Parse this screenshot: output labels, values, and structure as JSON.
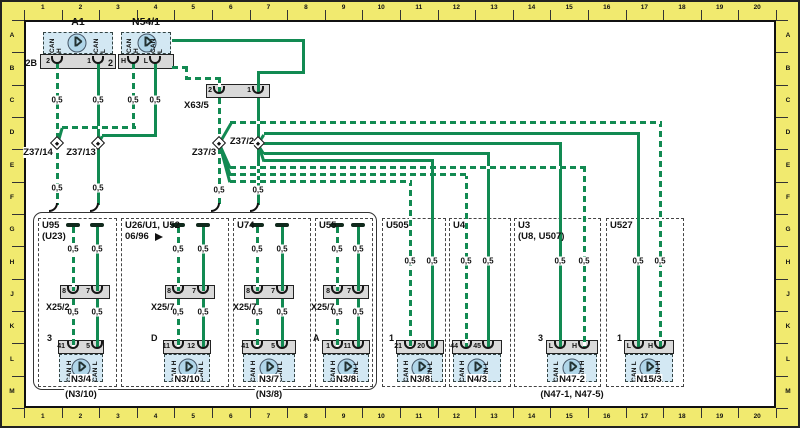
{
  "frame": {
    "columns": [
      "1",
      "2",
      "3",
      "4",
      "5",
      "6",
      "7",
      "8",
      "9",
      "10",
      "11",
      "12",
      "13",
      "14",
      "15",
      "16",
      "17",
      "18",
      "19",
      "20"
    ],
    "rows": [
      "A",
      "B",
      "C",
      "D",
      "E",
      "F",
      "G",
      "H",
      "J",
      "K",
      "L",
      "M"
    ]
  },
  "wire": {
    "gauge": "0,5",
    "green": "#128a52",
    "stripe_gap": "#ffffff"
  },
  "top": {
    "a1": {
      "name": "A1",
      "plug": "2B",
      "pins": [
        "2",
        "1"
      ],
      "can": [
        "CAN H",
        "CAN L"
      ]
    },
    "n54": {
      "name": "N54/1",
      "plug": "2",
      "pins": [
        "H",
        "L"
      ],
      "can": [
        "CAN H",
        "CAN L"
      ]
    },
    "x63": {
      "name": "X63/5",
      "pins": [
        "2",
        "1"
      ]
    },
    "splices": [
      "Z37/14",
      "Z37/13",
      "Z37/3",
      "Z37/2"
    ]
  },
  "sections": [
    {
      "titles": [
        "U95",
        "(U23)"
      ],
      "connector": {
        "name": "X25/2",
        "pins": [
          "8",
          "7"
        ]
      },
      "device": {
        "name": "N3/4",
        "subname": "(N3/10)",
        "plug": "3",
        "pins": [
          "41",
          "5"
        ],
        "can": [
          "CAN H",
          "CAN L"
        ]
      }
    },
    {
      "titles": [
        "U26/U1, U52",
        "06/96"
      ],
      "connector": {
        "name": "X25/7",
        "pins": [
          "8",
          "7"
        ]
      },
      "device": {
        "name": "N3/10",
        "plug": "D",
        "pins": [
          "11",
          "12"
        ],
        "can": [
          "CAN H",
          "CAN L"
        ]
      }
    },
    {
      "titles": [
        "U74"
      ],
      "connector": {
        "name": "X25/7",
        "pins": [
          "8",
          "7"
        ]
      },
      "device": {
        "name": "N3/7",
        "subname": "(N3/8)",
        "pins": [
          "41",
          "5"
        ],
        "can": [
          "CAN H",
          "CAN L"
        ]
      }
    },
    {
      "titles": [
        "U55"
      ],
      "connector": {
        "name": "X25/7",
        "pins": [
          "8",
          "7"
        ]
      },
      "device": {
        "name": "N3/8",
        "plug": "A",
        "pins": [
          "1",
          "11"
        ],
        "can": [
          "CAN H",
          "CAN L"
        ]
      }
    },
    {
      "titles": [
        "U505"
      ],
      "device": {
        "name": "N3/8",
        "plug": "1",
        "pins": [
          "21",
          "20"
        ],
        "can": [
          "CAN H",
          "CAN L"
        ]
      }
    },
    {
      "titles": [
        "U4"
      ],
      "device": {
        "name": "N4/3",
        "pins": [
          "44",
          "45"
        ],
        "can": [
          "CAN H",
          "CAN L"
        ]
      }
    },
    {
      "titles": [
        "U3",
        "(U8, U507)"
      ],
      "device": {
        "name": "N47-2",
        "subname": "(N47-1, N47-5)",
        "plug": "3",
        "pins": [
          "L",
          "H"
        ],
        "can": [
          "CAN L",
          "CAN H"
        ]
      }
    },
    {
      "titles": [
        "U527"
      ],
      "device": {
        "name": "N15/3",
        "plug": "1",
        "pins": [
          "L",
          "H"
        ],
        "can": [
          "CAN L",
          "CAN H"
        ]
      }
    }
  ]
}
